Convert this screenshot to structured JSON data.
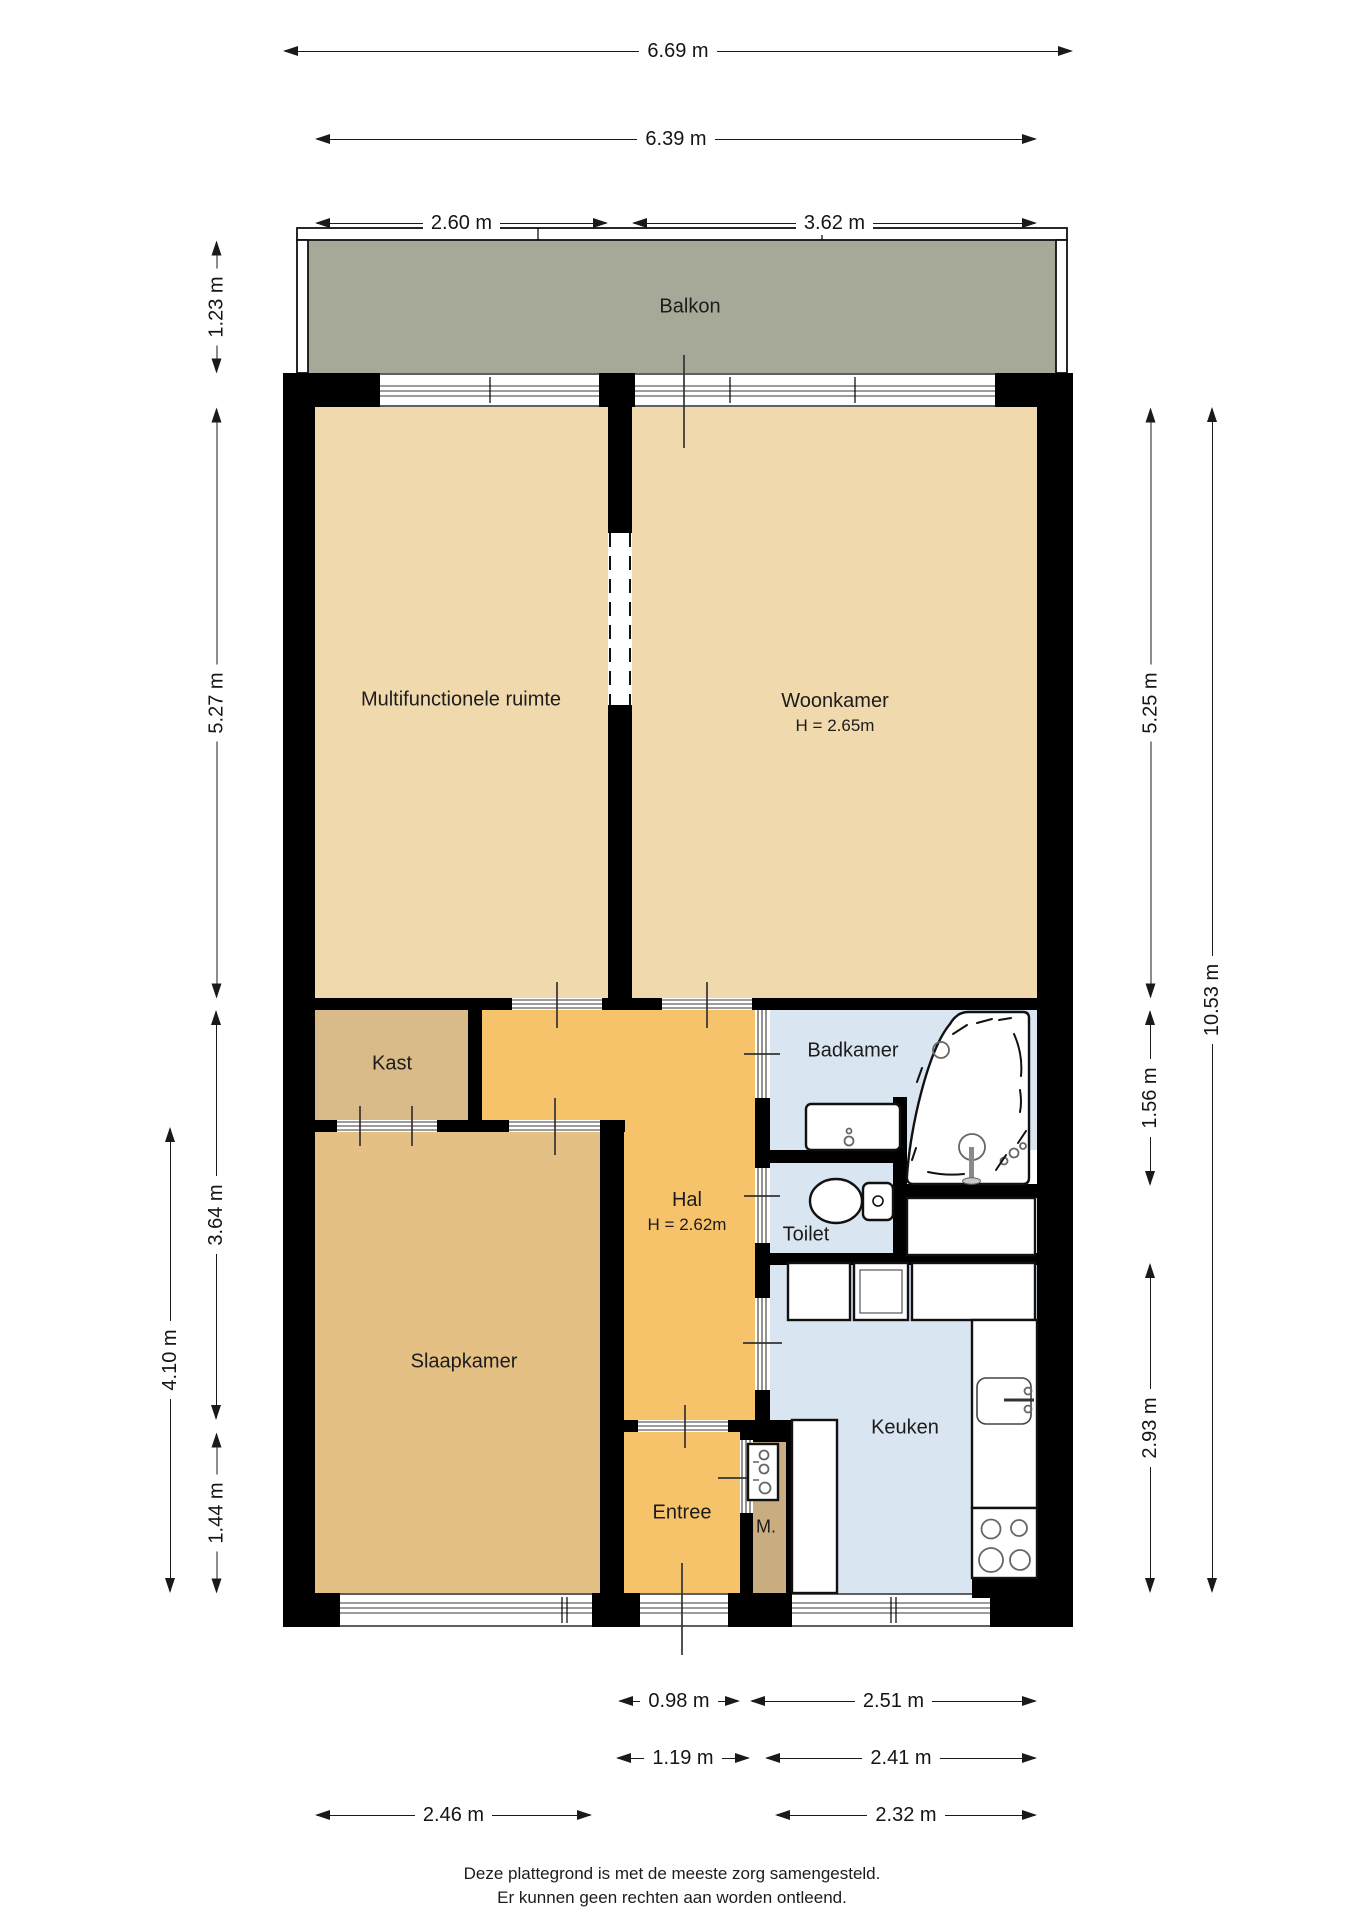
{
  "rooms": {
    "balkon": {
      "label": "Balkon"
    },
    "multifunctionele_ruimte": {
      "label": "Multifunctionele ruimte"
    },
    "woonkamer": {
      "label": "Woonkamer",
      "ceiling_height": "H = 2.65m"
    },
    "kast": {
      "label": "Kast"
    },
    "badkamer": {
      "label": "Badkamer"
    },
    "hal": {
      "label": "Hal",
      "ceiling_height": "H = 2.62m"
    },
    "toilet": {
      "label": "Toilet"
    },
    "slaapkamer": {
      "label": "Slaapkamer"
    },
    "keuken": {
      "label": "Keuken"
    },
    "entree": {
      "label": "Entree"
    },
    "meterkast": {
      "label": "M."
    }
  },
  "dims": {
    "top_total": "6.69 m",
    "top_inner": "6.39 m",
    "top_left_room": "2.60 m",
    "top_right_room": "3.62 m",
    "left_balkon": "1.23 m",
    "left_upper": "5.27 m",
    "left_mid": "3.64 m",
    "left_outer": "4.10 m",
    "left_lower": "1.44 m",
    "right_upper": "5.25 m",
    "right_total": "10.53 m",
    "right_badkamer": "1.56 m",
    "right_keuken": "2.93 m",
    "bottom_entree_1": "0.98 m",
    "bottom_keuken_1": "2.51 m",
    "bottom_entree_2": "1.19 m",
    "bottom_keuken_2": "2.41 m",
    "bottom_slaapkamer": "2.46 m",
    "bottom_keuken_3": "2.32 m"
  },
  "footer": {
    "line1": "Deze plattegrond is met de meeste zorg samengesteld.",
    "line2": "Er kunnen geen rechten aan worden ontleend."
  },
  "colors": {
    "wall": "#000000",
    "balkon": "#a6a997",
    "room_tan": "#f0d9ad",
    "kast": "#d8bb88",
    "slaapkamer": "#e4c085",
    "hal": "#f6c36b",
    "meterkast": "#c9ad80",
    "wet": "#d9e5f1"
  }
}
